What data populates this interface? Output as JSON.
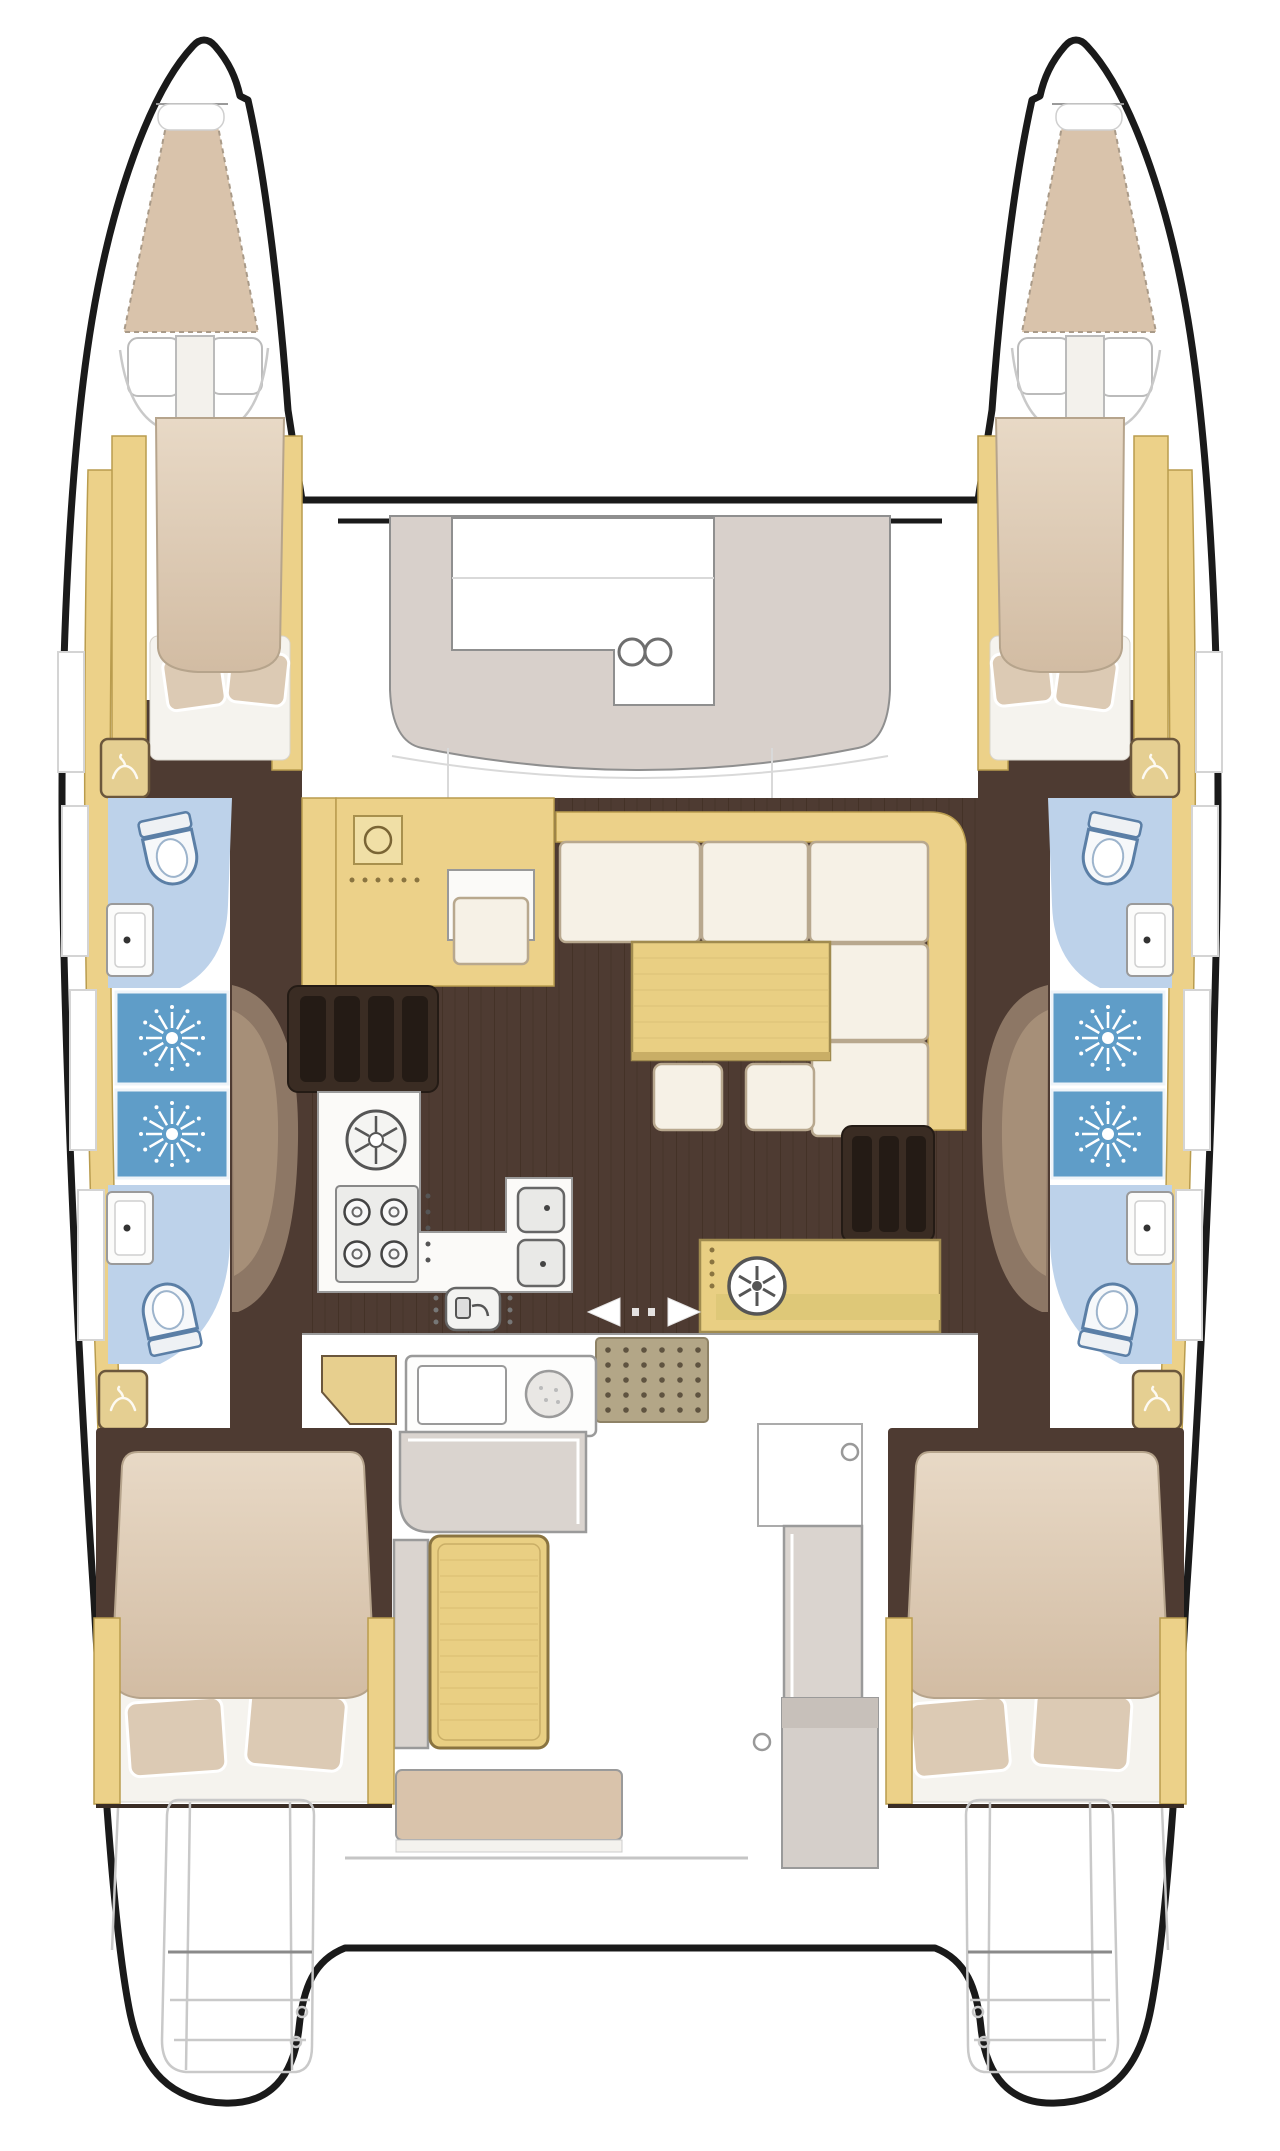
{
  "diagram": {
    "type": "boat-floor-plan",
    "vessel": "sailing catamaran",
    "view": "top-down interior layout",
    "orientation": "bows at top, sterns at bottom"
  },
  "palette": {
    "hull_outline": "#1a1a1a",
    "deck_white": "#ffffff",
    "wood_counter": "#ecd189",
    "wood_table": "#e9cf83",
    "wood_trim": "#b99c4e",
    "bed_linen_light": "#e8d9c6",
    "bed_linen": "#d2bca3",
    "pillow": "#dccab4",
    "floor_brown": "#4e3b32",
    "stair_brown": "#2f251e",
    "bulkhead_tan": "#8d7765",
    "bath_floor_blue": "#bdd2ea",
    "shower_blue": "#5f9dc8",
    "fixture_blue": "#5b7fa6",
    "cushion_gray": "#dad4cf",
    "sunpad_gray": "#d8d0cb",
    "sofa_cream": "#f6f1e6",
    "mat_tan": "#b3a687",
    "steps_gray": "#c9c9c9"
  },
  "areas": {
    "port_forepeak": {
      "label": "Port forepeak berth"
    },
    "starboard_forepeak": {
      "label": "Starboard forepeak berth"
    },
    "forward_cockpit": {
      "label": "Forward cockpit lounge pad with two deck hatches"
    },
    "port_forward_cabin": {
      "label": "Port forward double cabin"
    },
    "starboard_forward_cabin": {
      "label": "Starboard forward double cabin"
    },
    "port_forward_bathroom": {
      "label": "Port forward bathroom with toilet and washbasin"
    },
    "starboard_forward_bathroom": {
      "label": "Starboard forward bathroom with toilet and washbasin"
    },
    "port_showers": {
      "label": "Port shower stalls"
    },
    "starboard_showers": {
      "label": "Starboard shower stalls"
    },
    "port_aft_bathroom": {
      "label": "Port aft bathroom with toilet and washbasin"
    },
    "starboard_aft_bathroom": {
      "label": "Starboard aft bathroom with toilet and washbasin"
    },
    "port_aft_cabin": {
      "label": "Port aft double cabin"
    },
    "starboard_aft_cabin": {
      "label": "Starboard aft double cabin"
    },
    "salon": {
      "label": "Main salon with L-shaped sofa and dining table"
    },
    "galley": {
      "label": "Galley with round sink, four-burner stove and double sink"
    },
    "nav_station": {
      "label": "Chart table with instrument dial"
    },
    "cockpit": {
      "label": "Aft cockpit with table and benches"
    },
    "port_stern": {
      "label": "Port transom swim steps"
    },
    "starboard_stern": {
      "label": "Starboard transom swim steps"
    }
  },
  "inventory": {
    "double_beds": 4,
    "forepeak_berths": 2,
    "toilets": 4,
    "washbasins": 4,
    "shower_stalls": 4,
    "wardrobes": 4,
    "dining_tables": 1,
    "cockpit_tables": 1,
    "stools": 2,
    "deck_hatches": 2,
    "companionway_stairs": 2
  }
}
